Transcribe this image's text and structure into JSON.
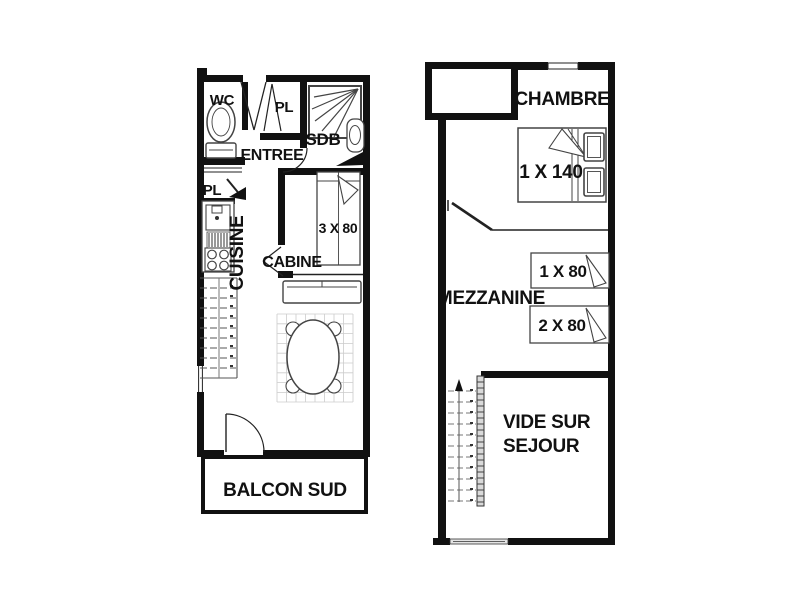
{
  "diagram": {
    "type": "floor-plan",
    "levels": [
      {
        "name": "lower-level",
        "labels": {
          "wc": "WC",
          "pl_entry": "PL",
          "sdb": "SDB",
          "entree": "ENTREE",
          "pl_kitchen": "PL",
          "cuisine": "CUISINE",
          "cabine": "CABINE",
          "bed_cabine": "3 X 80",
          "balcon": "BALCON SUD"
        }
      },
      {
        "name": "upper-level",
        "labels": {
          "chambre": "CHAMBRE",
          "bed_double": "1 X 140",
          "mezzanine": "MEZZANINE",
          "bed_single_1": "1 X 80",
          "bed_single_2": "2 X 80",
          "vide_line1": "VIDE SUR",
          "vide_line2": "SEJOUR"
        }
      }
    ],
    "colors": {
      "wall": "#111111",
      "line": "#333333",
      "furniture": "#555555",
      "grid": "#cccccc"
    }
  }
}
